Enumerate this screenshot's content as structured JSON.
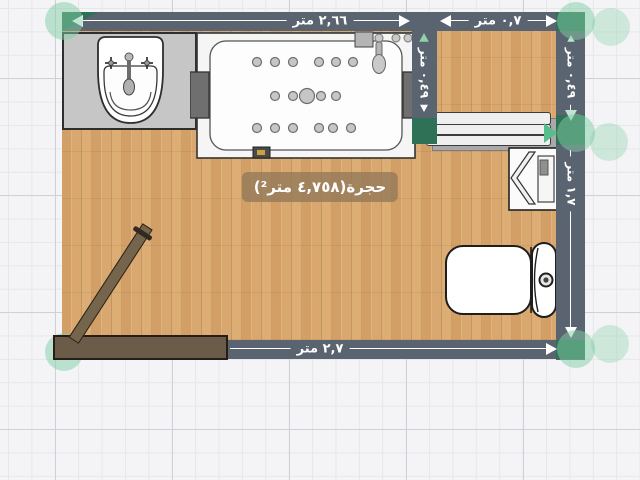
{
  "editor": {
    "view": "2d-floor-plan"
  },
  "room": {
    "label": "حجرة(٤,٧٥٨ متر²)",
    "name": "حجرة",
    "area": "٤,٧٥٨"
  },
  "dimensions": {
    "top_main": "٢,٦٦ متر",
    "top_niche": "٠,٧ متر",
    "inner_wall": "٠,٤٩ متر",
    "right_upper": "٠,٤٩ متر",
    "right_lower": "١,٧ متر",
    "bottom": "٢,٧ متر"
  },
  "fixtures": [
    "sink",
    "bathtub",
    "towel-shelf",
    "water-heater",
    "toilet",
    "door"
  ],
  "colors": {
    "wall": "#5a6370",
    "floor_wood": "#d7a56c",
    "selection_handle": "#7fcda3",
    "selection_corner": "#2f7157",
    "dimension_text": "#ffffff",
    "door": "#6b5c4a"
  }
}
